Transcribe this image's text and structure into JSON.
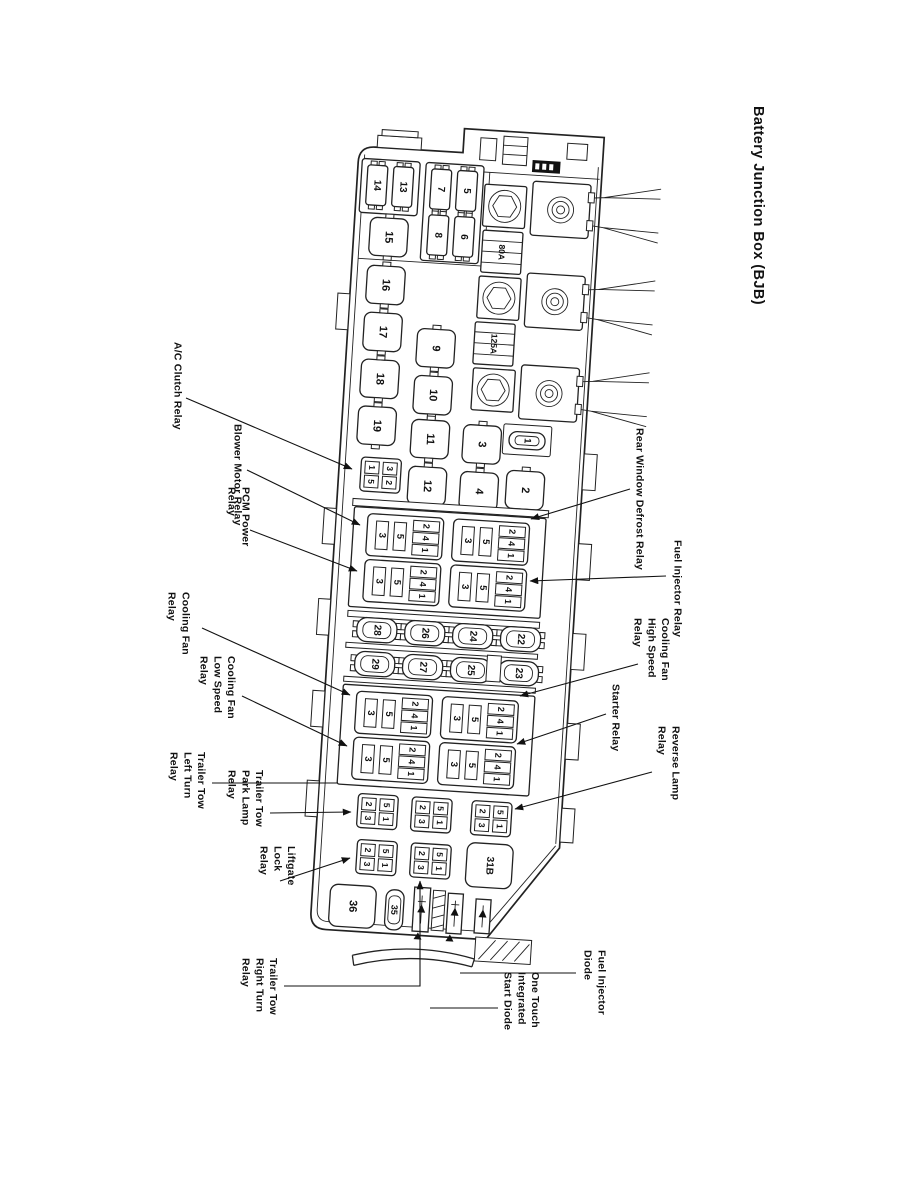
{
  "page": {
    "title": "Battery Junction Box (BJB)"
  },
  "box": {
    "top_fuses": {
      "f14": "14",
      "f13": "13",
      "f7": "7",
      "f5": "5",
      "f8": "8",
      "f6": "6"
    },
    "relays": {
      "r15": "15",
      "r16": "16",
      "r17": "17",
      "r18": "18",
      "r19": "19",
      "r9": "9",
      "r10": "10",
      "r11": "11",
      "r12": "12",
      "r3": "3",
      "r4": "4",
      "r1": "1",
      "r2": "2"
    },
    "fuse_links": {
      "link1": "80A",
      "link2": "125A"
    },
    "socket_pins": {
      "slots": [
        "3",
        "5"
      ],
      "stack": [
        "2",
        "4",
        "1"
      ]
    },
    "socket_a_pins": [
      "1",
      "3",
      "5",
      "2"
    ],
    "mini_pins": [
      "2",
      "5",
      "3",
      "1"
    ],
    "fuse_strip": {
      "row1": [
        "28",
        "26",
        "24",
        "22"
      ],
      "row2": [
        "29",
        "27",
        "25",
        "23"
      ]
    },
    "blocks": {
      "b31": "31B",
      "b36": "36",
      "f35": "35"
    }
  },
  "callouts": {
    "ac_clutch": "A/C Clutch Relay",
    "blower": "Blower Motor Relay",
    "pcm": "PCM Power\nRelay",
    "cooling_fan": "Cooling Fan\nRelay",
    "cooling_fan_low": "Cooling Fan\nLow Speed\nRelay",
    "tt_left": "Trailer Tow\nLeft Turn\nRelay",
    "tt_park": "Trailer Tow\nPark Lamp\nRelay",
    "liftgate": "Liftgate\nLock\nRelay",
    "tt_right": "Trailer Tow\nRight Turn\nRelay",
    "one_touch": "One Touch\nIntegrated\nStart Diode",
    "fuel_diode": "Fuel Injector\nDiode",
    "rear_defrost": "Rear Window Defrost Relay",
    "fuel_relay": "Fuel Injector Relay",
    "cf_high": "Cooling Fan\nHigh Speed\nRelay",
    "starter": "Starter Relay",
    "reverse": "Reverse Lamp\nRelay"
  }
}
